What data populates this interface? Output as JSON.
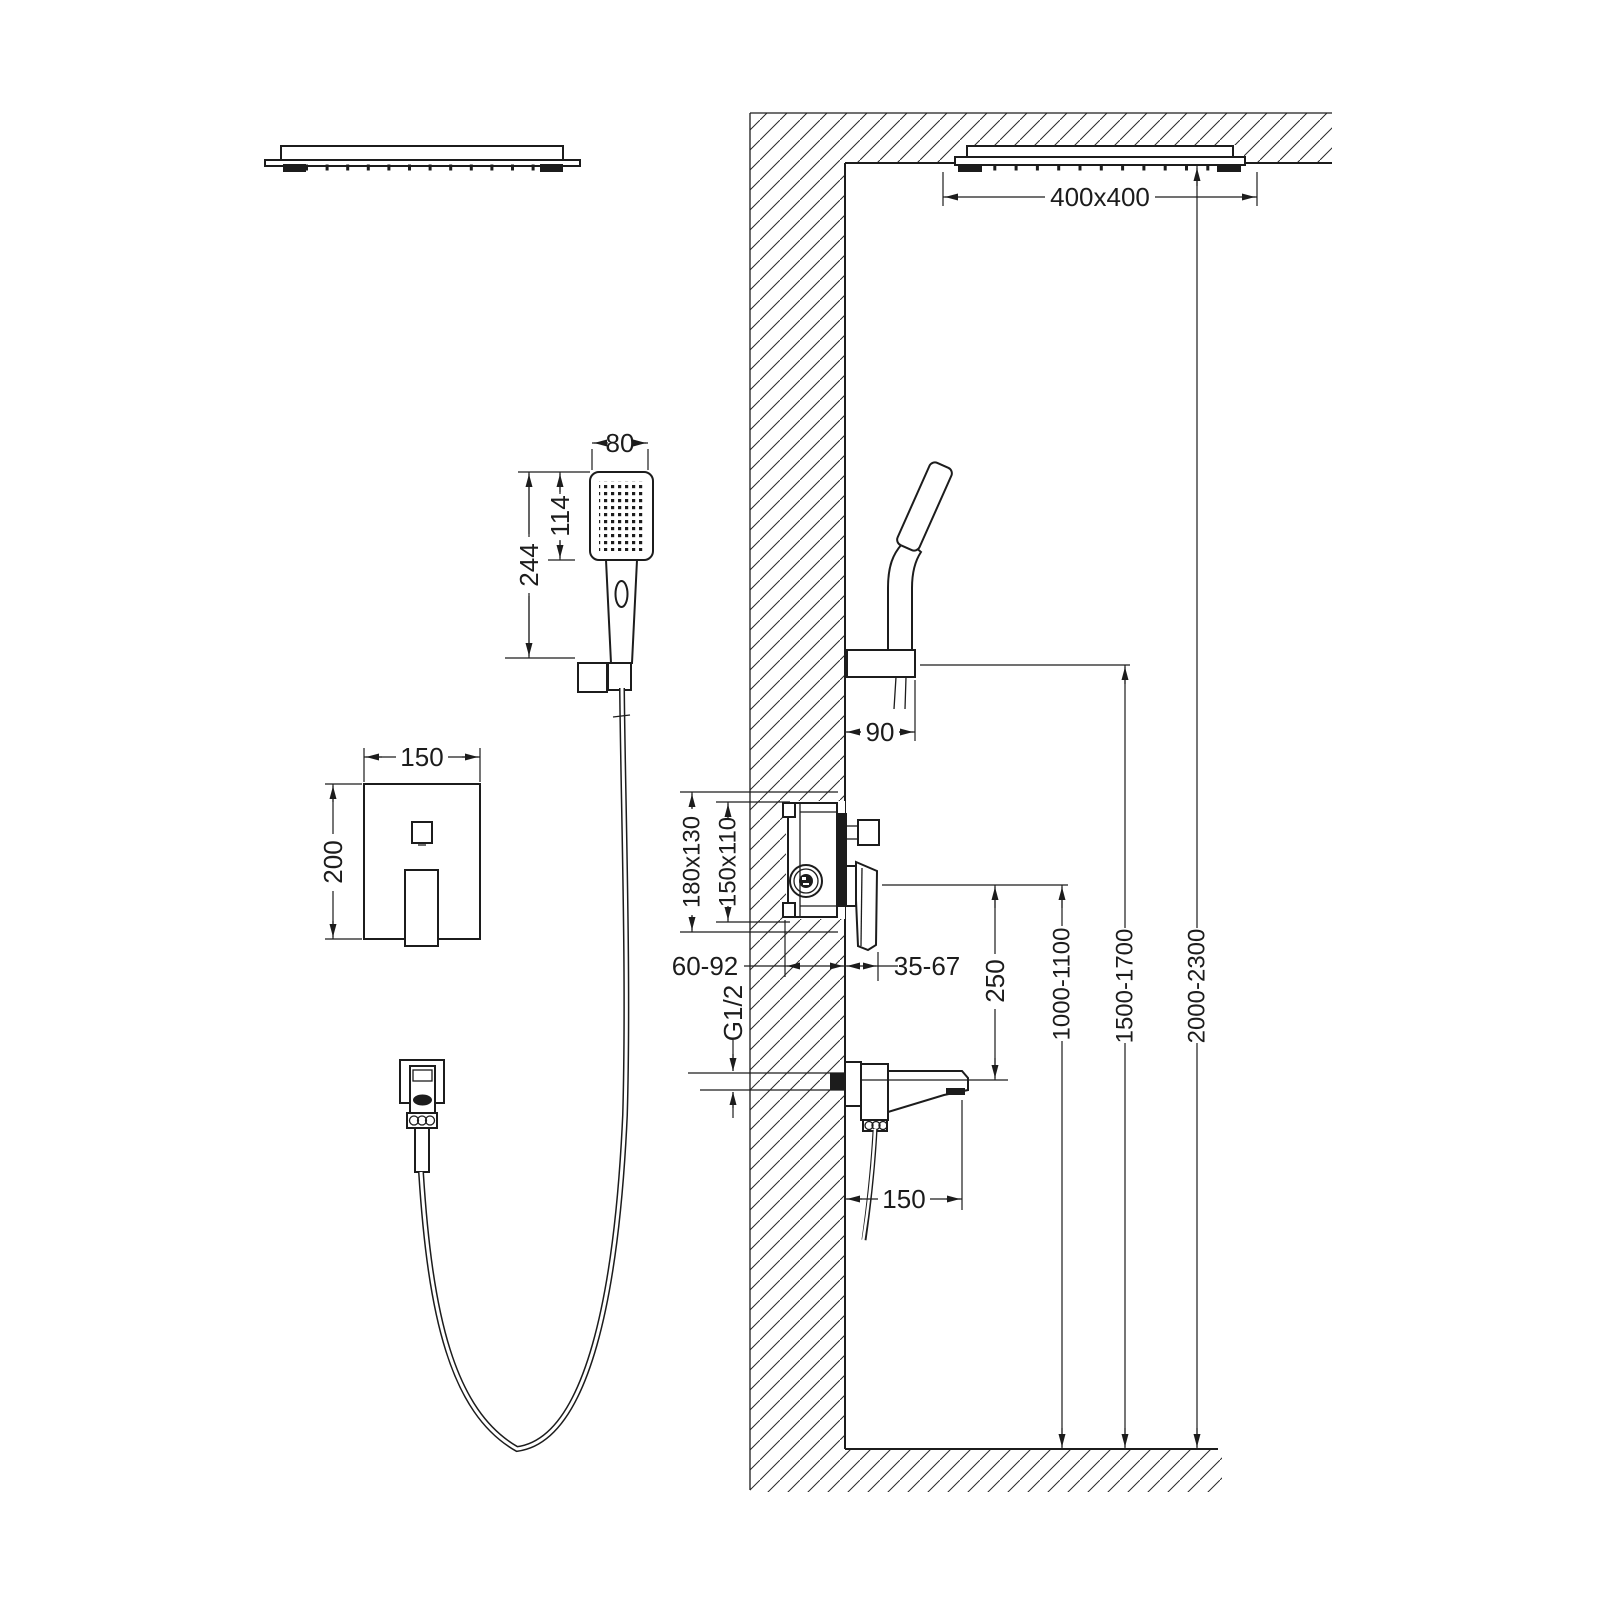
{
  "drawing": {
    "type": "shower-system-installation-diagram",
    "colors": {
      "line": "#1c1c1c",
      "background": "#ffffff"
    },
    "dims": {
      "overhead_size": "400x400",
      "handshower_width": "80",
      "handshower_face": "114",
      "handshower_length": "244",
      "holder_reach": "90",
      "plate_width": "150",
      "plate_height": "200",
      "valve_outer": "180x130",
      "valve_inner": "150x110",
      "depth_in_wall": "60-92",
      "depth_out_wall": "35-67",
      "thread": "G1/2",
      "spout_drop": "250",
      "spout_reach": "150",
      "height_valve": "1000-1100",
      "height_holder": "1500-1700",
      "height_overhead": "2000-2300"
    }
  }
}
